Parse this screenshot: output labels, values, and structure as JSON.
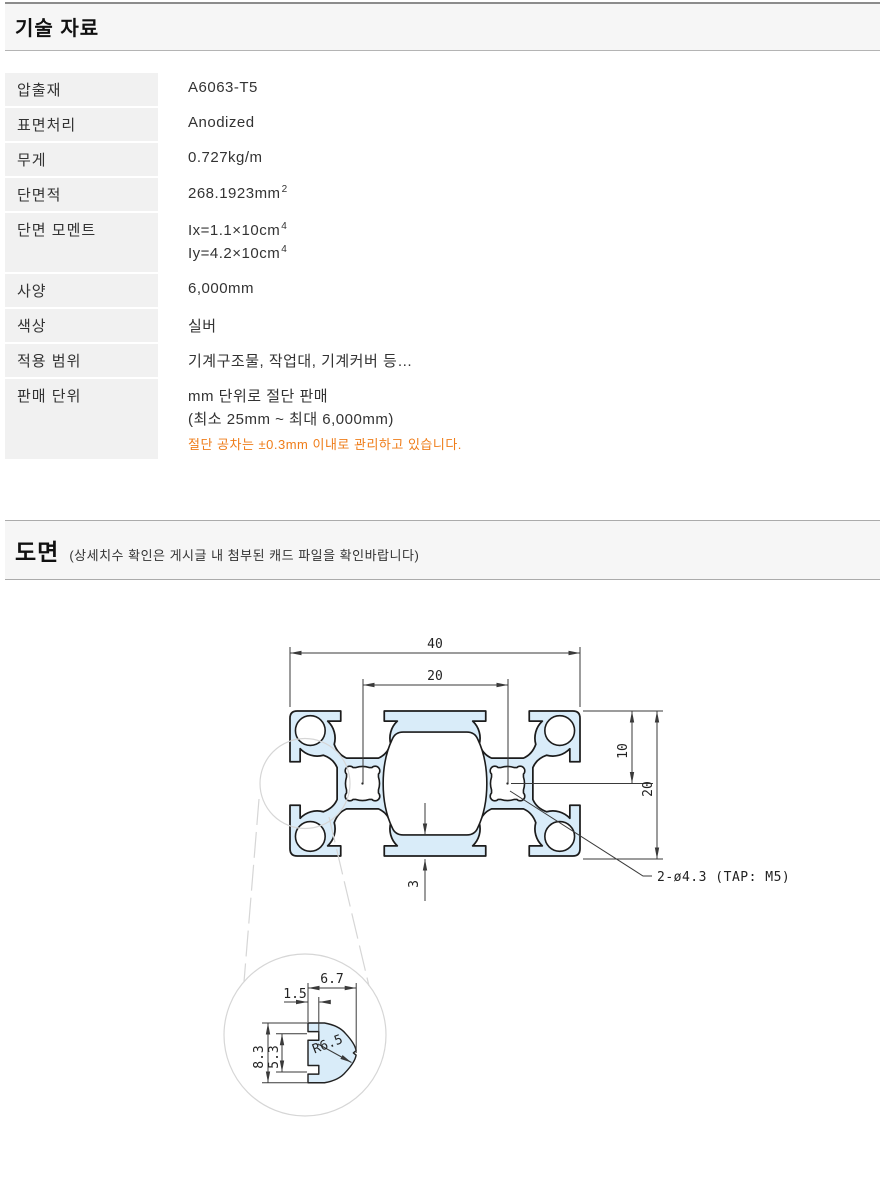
{
  "colors": {
    "accent_orange": "#ef7d1a",
    "profile_fill": "#d9ecf9",
    "outline": "#1c1c1c",
    "dimension_line": "#3a3a3a",
    "construction": "#d6d6d6",
    "section_bar_bg": "#f6f6f6",
    "label_cell_bg": "#f1f1f1"
  },
  "tech": {
    "title": "기술 자료",
    "rows": {
      "extrusion": {
        "label": "압출재",
        "value": "A6063-T5"
      },
      "surface": {
        "label": "표면처리",
        "value": "Anodized"
      },
      "weight": {
        "label": "무게",
        "value": "0.727kg/m"
      },
      "area": {
        "label": "단면적",
        "value": "268.1923mm",
        "sup": "2"
      },
      "moment": {
        "label": "단면 모멘트",
        "ix": "Ix=1.1×10cm",
        "ix_sup": "4",
        "iy": "Iy=4.2×10cm",
        "iy_sup": "4"
      },
      "spec": {
        "label": "사양",
        "value": "6,000mm"
      },
      "color": {
        "label": "색상",
        "value": "실버"
      },
      "application": {
        "label": "적용 범위",
        "value": "기계구조물, 작업대, 기계커버 등…"
      },
      "sales": {
        "label": "판매 단위",
        "line1": "mm 단위로 절단 판매",
        "line2": "(최소 25mm ~ 최대 6,000mm)",
        "tolerance_note": "절단 공차는 ±0.3mm 이내로 관리하고 있습니다."
      }
    }
  },
  "drawing": {
    "title": "도면",
    "note": "(상세치수 확인은 게시글 내 첨부된 캐드 파일을 확인바랍니다)",
    "dimensions": {
      "overall_width": "40",
      "slot_pitch": "20",
      "half_height": "10",
      "overall_height": "20",
      "bottom_wall": "3",
      "tap_note": "2-ø4.3 (TAP: M5)",
      "detail_depth": "6.7",
      "detail_lip": "1.5",
      "detail_outer_height": "8.3",
      "detail_inner_height": "5.3",
      "detail_radius": "R6.5"
    }
  }
}
